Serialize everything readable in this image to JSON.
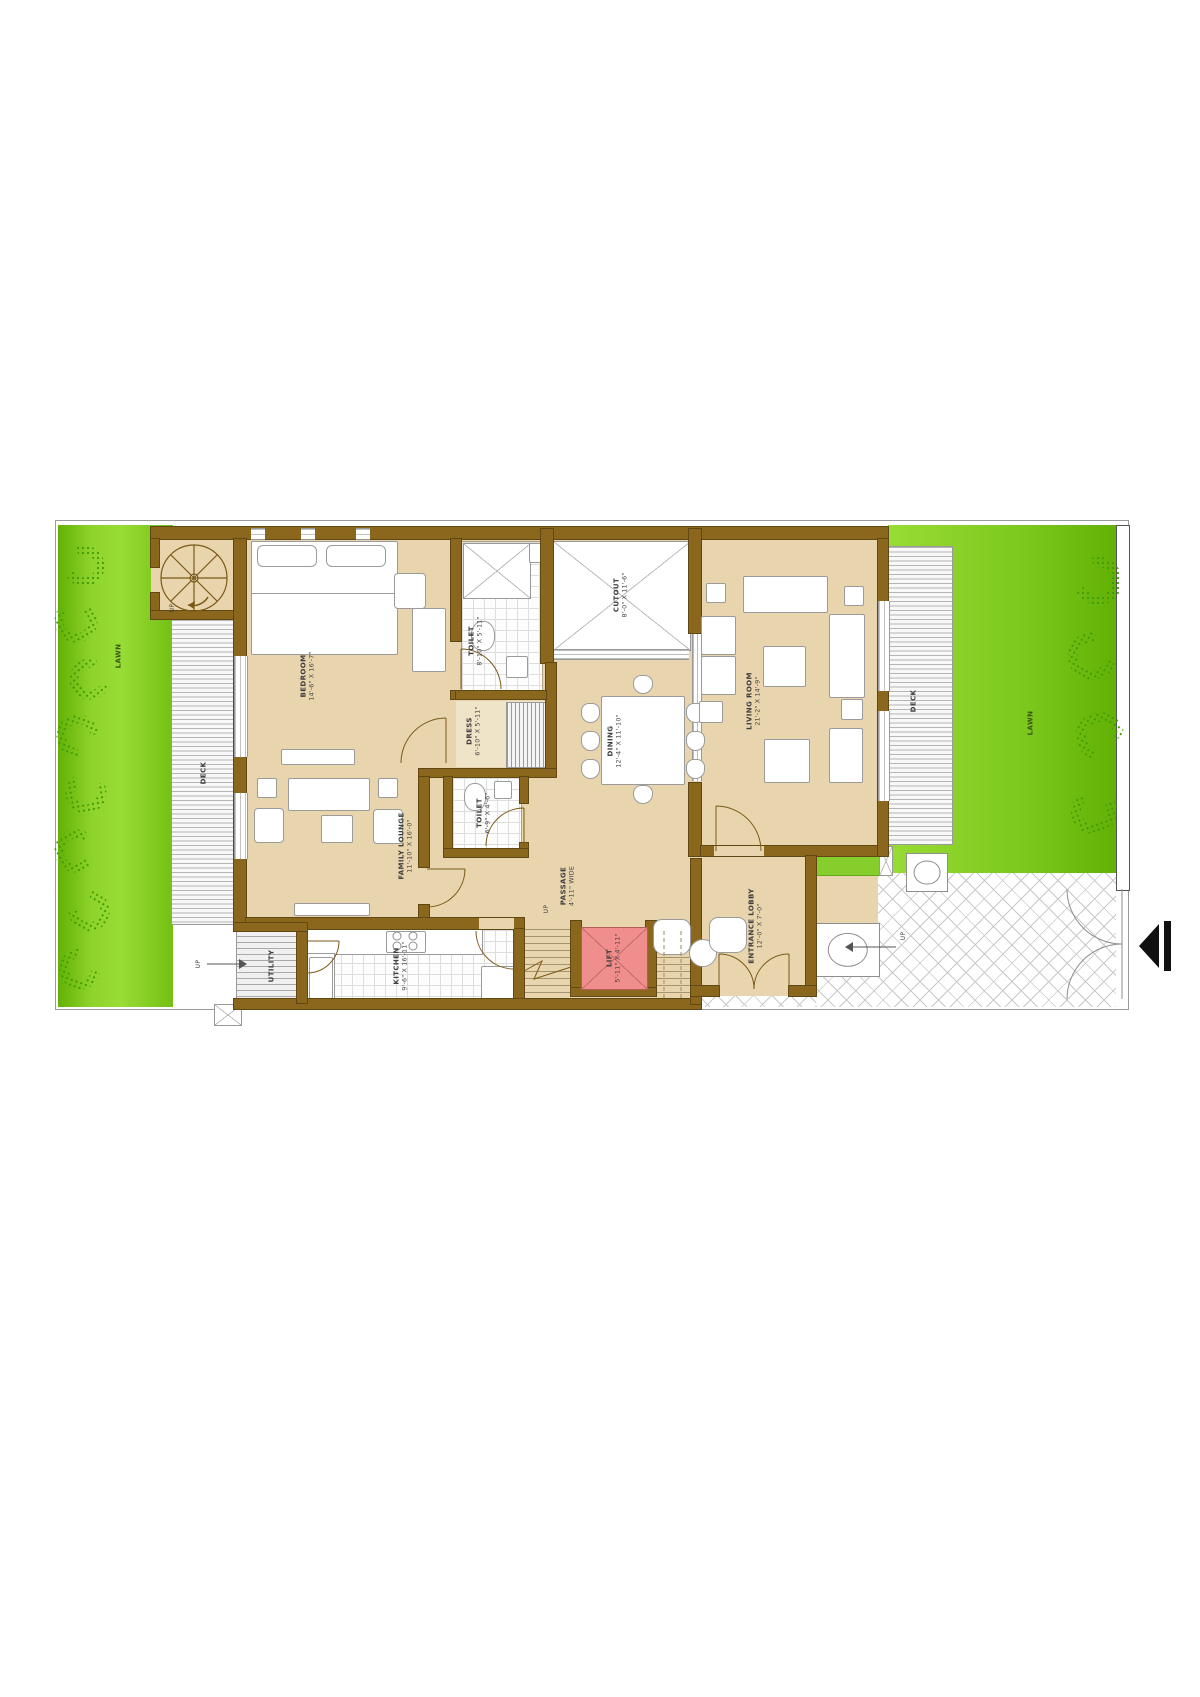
{
  "title": "Residential floor plan",
  "rooms": {
    "bedroom": {
      "name": "BEDROOM",
      "dims": "14'-6\" X 16'-7\""
    },
    "toilet_top": {
      "name": "TOILET",
      "dims": "8'-10\" X 5'-11\""
    },
    "dress": {
      "name": "DRESS",
      "dims": "6'-10\" X 5'-11\""
    },
    "toilet_mid": {
      "name": "TOILET",
      "dims": "6'-9\" X 4'-6\""
    },
    "family_lounge": {
      "name": "FAMILY LOUNGE",
      "dims": "11'-10\" X 16'-0\""
    },
    "kitchen": {
      "name": "KITCHEN",
      "dims": "9'-6\" X 16'-11\""
    },
    "cutout": {
      "name": "CUTOUT",
      "dims": "8'-0\" X 11'-6\""
    },
    "dining": {
      "name": "DINING",
      "dims": "12'-4\" X 11'-10\""
    },
    "living": {
      "name": "LIVING ROOM",
      "dims": "21'-2\" X 14'-9\""
    },
    "passage": {
      "name": "PASSAGE",
      "dims": "4'-11\" WIDE"
    },
    "lift": {
      "name": "LIFT",
      "dims": "5'-11\" X 4'-11\""
    },
    "lobby": {
      "name": "ENTRANCE LOBBY",
      "dims": "12'-0\" X 7'-0\""
    },
    "utility": {
      "name": "UTILITY"
    }
  },
  "areas": {
    "lawn_left": "LAWN",
    "lawn_right": "LAWN",
    "deck_left": "DECK",
    "deck_right": "DECK"
  },
  "markers": {
    "up_spiral": "UP",
    "up_stairs": "UP",
    "up_utility": "UP",
    "up_porch": "UP"
  },
  "colors": {
    "wall": "#8a671c",
    "floor": "#e8d5ae",
    "lawn": "#8fd42c",
    "lift": "#f08d8d",
    "bush": "#3c9b02"
  }
}
